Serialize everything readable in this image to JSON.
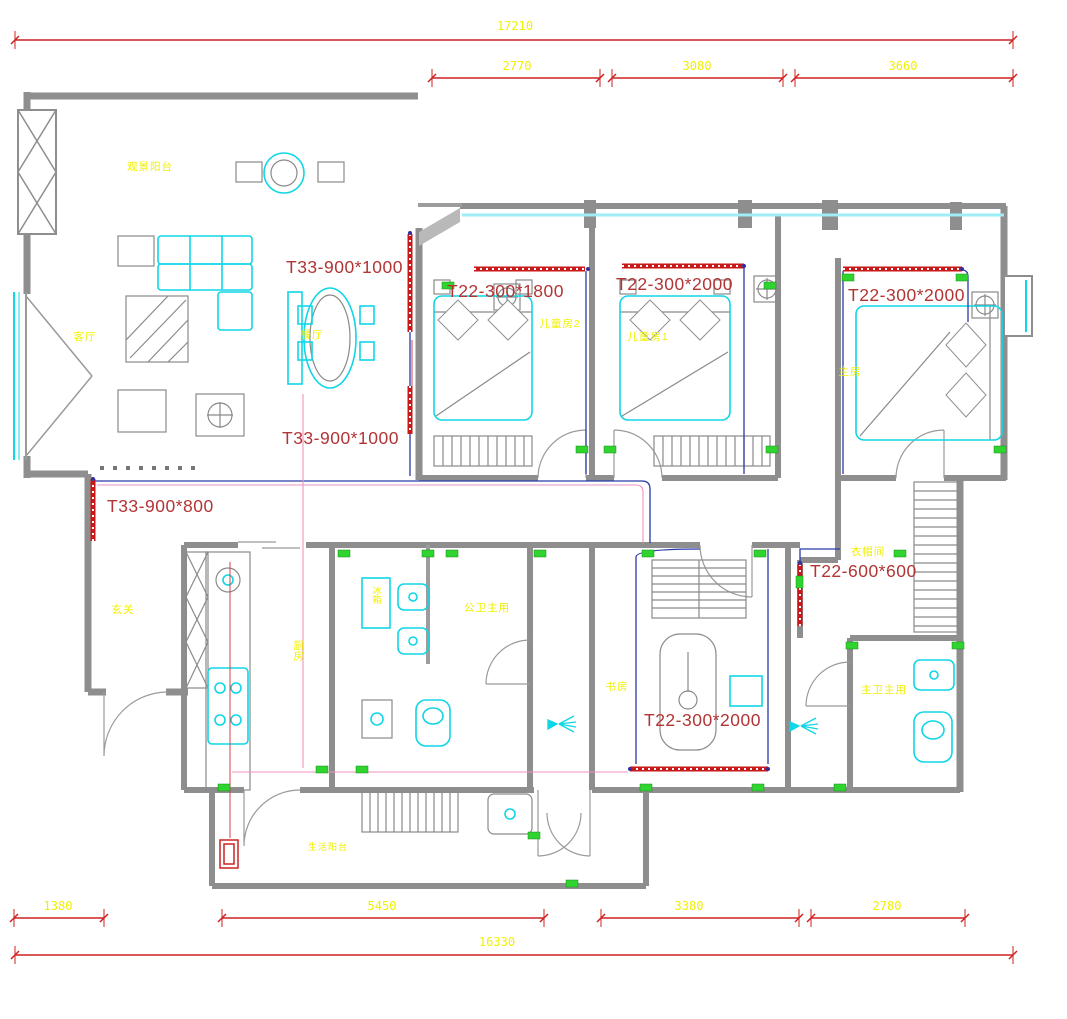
{
  "drawing": {
    "dimensions": {
      "top": {
        "total": "17210",
        "seg1": "2770",
        "seg2": "3080",
        "seg3": "3660"
      },
      "bottom": {
        "seg1": "1380",
        "seg2": "5450",
        "seg3": "3380",
        "seg4": "2780",
        "total": "16330"
      }
    },
    "annotations": {
      "dining_strip": "T33-900*1000",
      "hall_strip": "T33-900*1000",
      "entry_strip": "T33-900*800",
      "bed2_strip": "T22-300*1800",
      "bed1_strip": "T22-300*2000",
      "master_strip": "T22-300*2000",
      "closet_strip": "T22-600*600",
      "study_strip": "T22-300*2000"
    },
    "rooms": {
      "view_balcony": "观景阳台",
      "living": "客厅",
      "dining": "餐厅",
      "kids_bed_2": "儿童房2",
      "kids_bed_1": "儿童房1",
      "master_bed": "主房",
      "entry": "玄关",
      "kitchen": "厨房",
      "public_bath": "公卫主用",
      "study": "书房",
      "cloakroom": "衣帽间",
      "master_bath": "主卫主用",
      "service_balcony": "生活阳台",
      "fridge": "冰箱"
    },
    "colors": {
      "dimension_red": "#cf2020",
      "label_yellow": "#f0f000",
      "annotation_red": "#b23434",
      "fixture_cyan": "#10d6e6",
      "wall_gray": "#8e8e8e",
      "wiring_navy": "#2839a8",
      "wiring_pink": "#ef93bd",
      "switch_green": "#2fd42f",
      "led_strip_red": "#c81818"
    }
  }
}
